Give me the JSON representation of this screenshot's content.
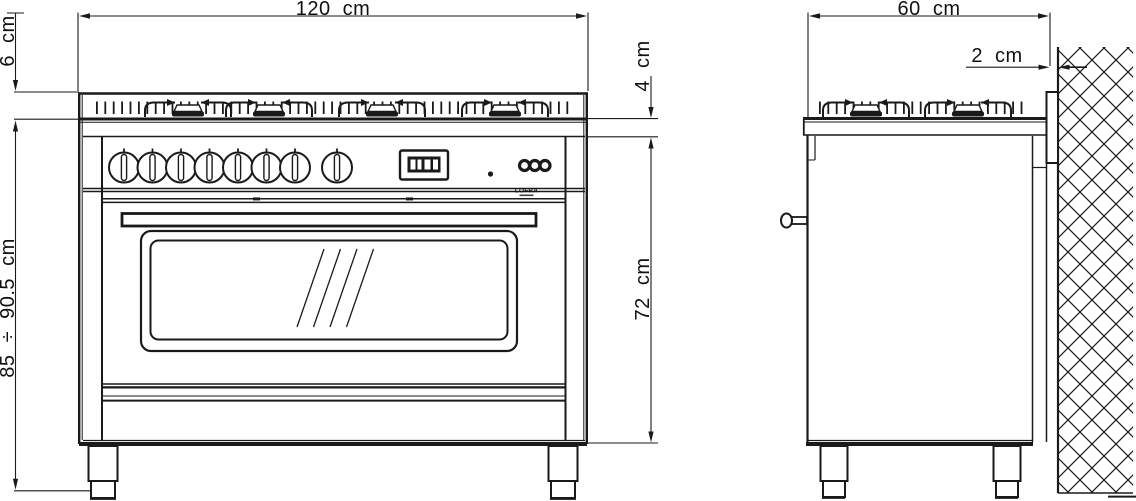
{
  "drawing": {
    "type": "appliance-installation-dimension-diagram",
    "subject": "freestanding range cooker, front and side elevation",
    "colors": {
      "line": "#1a1a1a",
      "background": "#ffffff"
    },
    "dimensions": {
      "width": "120 cm",
      "backguard_height": "6 cm",
      "hob_lip_height": "4 cm",
      "overall_height": "85 ÷ 90.5 cm",
      "oven_front_height": "72 cm",
      "depth": "60 cm",
      "wall_clearance": "2 cm"
    },
    "brand": "LOFRA",
    "features": {
      "front_knob_count": 8,
      "front_burner_caps": 4,
      "side_burner_caps": 2,
      "buttons": 3
    }
  }
}
